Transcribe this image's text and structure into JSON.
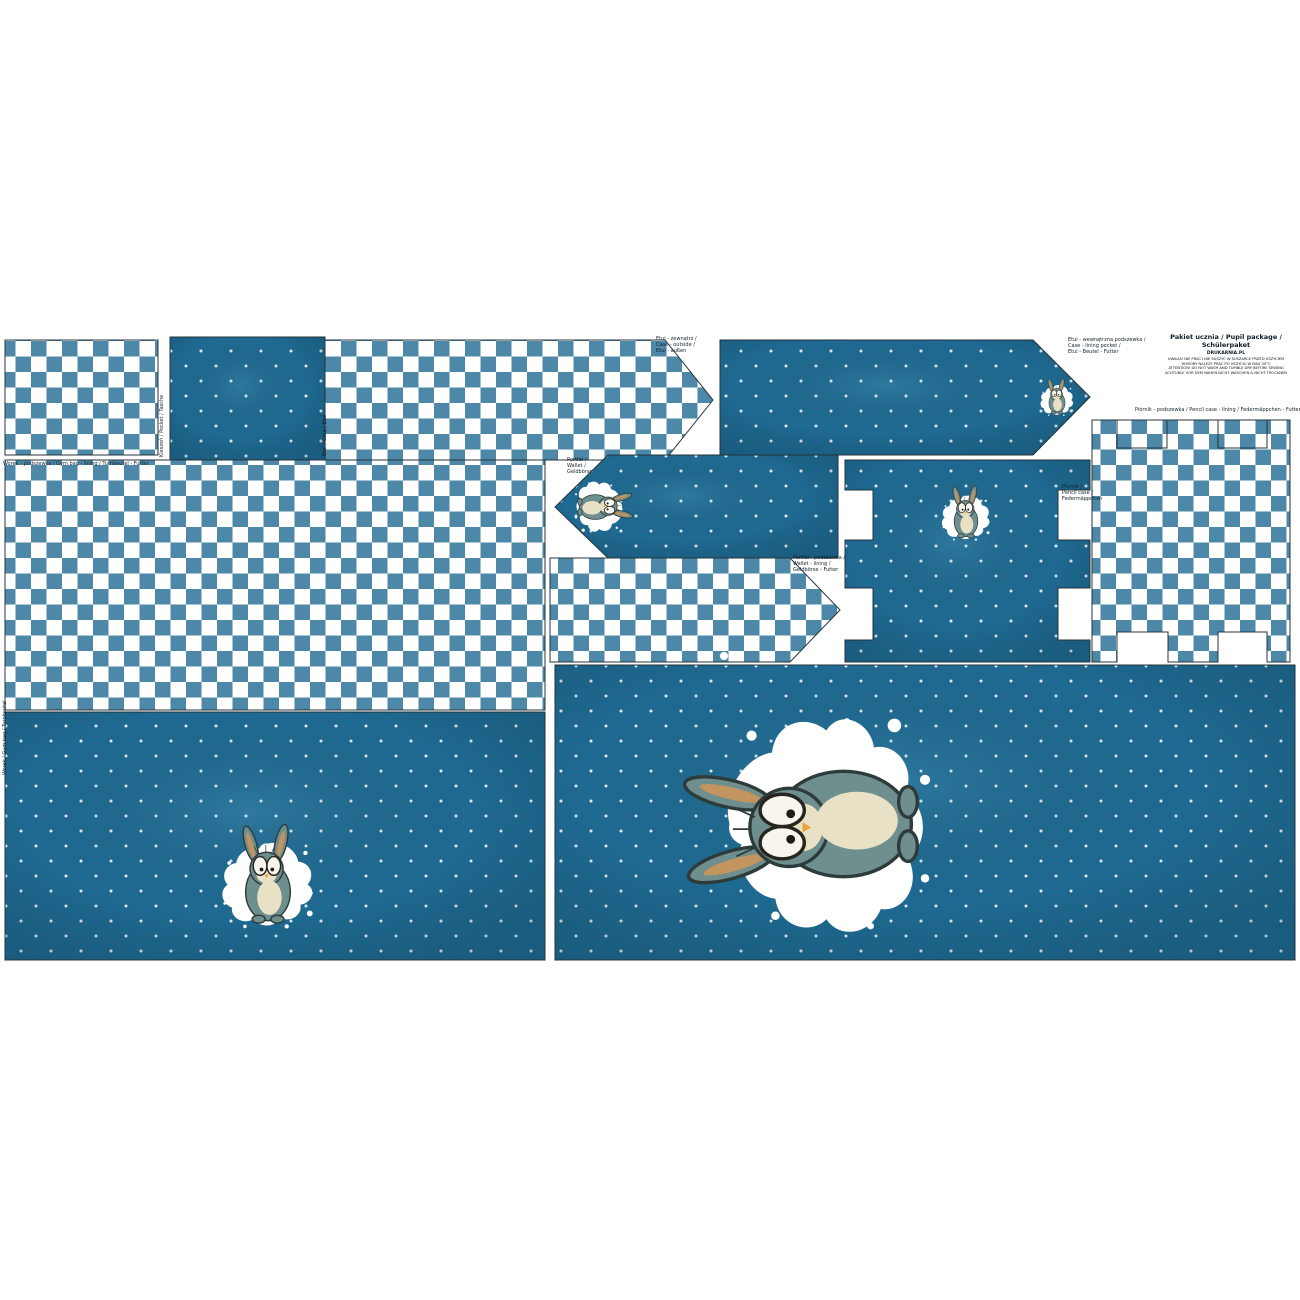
{
  "header": {
    "title": "Pakiet ucznia / Pupil package / Schülerpaket",
    "brand": "DRUKARNIA.PL",
    "notes": [
      "UWAGA! NIE PRAĆ I NIE SUSZYĆ W SUSZARCE PRZED USZYCIEM",
      "WYROBY NALEŻY PRAĆ PO USZYCIU W MAX 30°C",
      "ATTENTION! DO NOT WASH AND TUMBLE DRY BEFORE SEWING",
      "ACHTUNG! VOR DEM NÄHEN NICHT WASCHEN & NICHT TROCKNEN"
    ]
  },
  "labels": {
    "etui_outer": [
      "Etui - zewnątrz /",
      "Case - outside /",
      "Etui - außen"
    ],
    "etui_lining": [
      "Etui - wewnętrzna podszewka /",
      "Case - lining pocket /",
      "Etui - Beutel - Futter"
    ],
    "pencil_lining": "Piórnik - podszewka / Pencil case - lining / Federmäppchen - Futter",
    "wallet": [
      "Portfel /",
      "Wallet /",
      "Geldbörse"
    ],
    "wallet_lining": [
      "Portfel - podszewka /",
      "Wallet - lining /",
      "Geldbörse - Futter"
    ],
    "pencil": [
      "Piórnik /",
      "Pencil case /",
      "Federmäppchen"
    ],
    "gymbag_lining": "Worek - podszewka / Gym bag - lining / Turnbeutel - Futter",
    "pocket_side": "Kieszeń / Pocket / Tasche",
    "etui_side": "Etui / Case / Etui",
    "gymbag_side": "Worek / Gym bag / Turnbeutel"
  },
  "colors": {
    "solid_blue": "#1f6a92",
    "checker_blue": "#4e88a8",
    "checker_white": "#ffffff",
    "dot_white": "#ddecf4",
    "outline": "#24343c",
    "splat_white": "#ffffff",
    "bunny_fur": "#6f8e8e",
    "bunny_belly": "#e9e1c6",
    "bunny_ear_inner": "#c2945f",
    "bunny_nose": "#e8a33b"
  }
}
